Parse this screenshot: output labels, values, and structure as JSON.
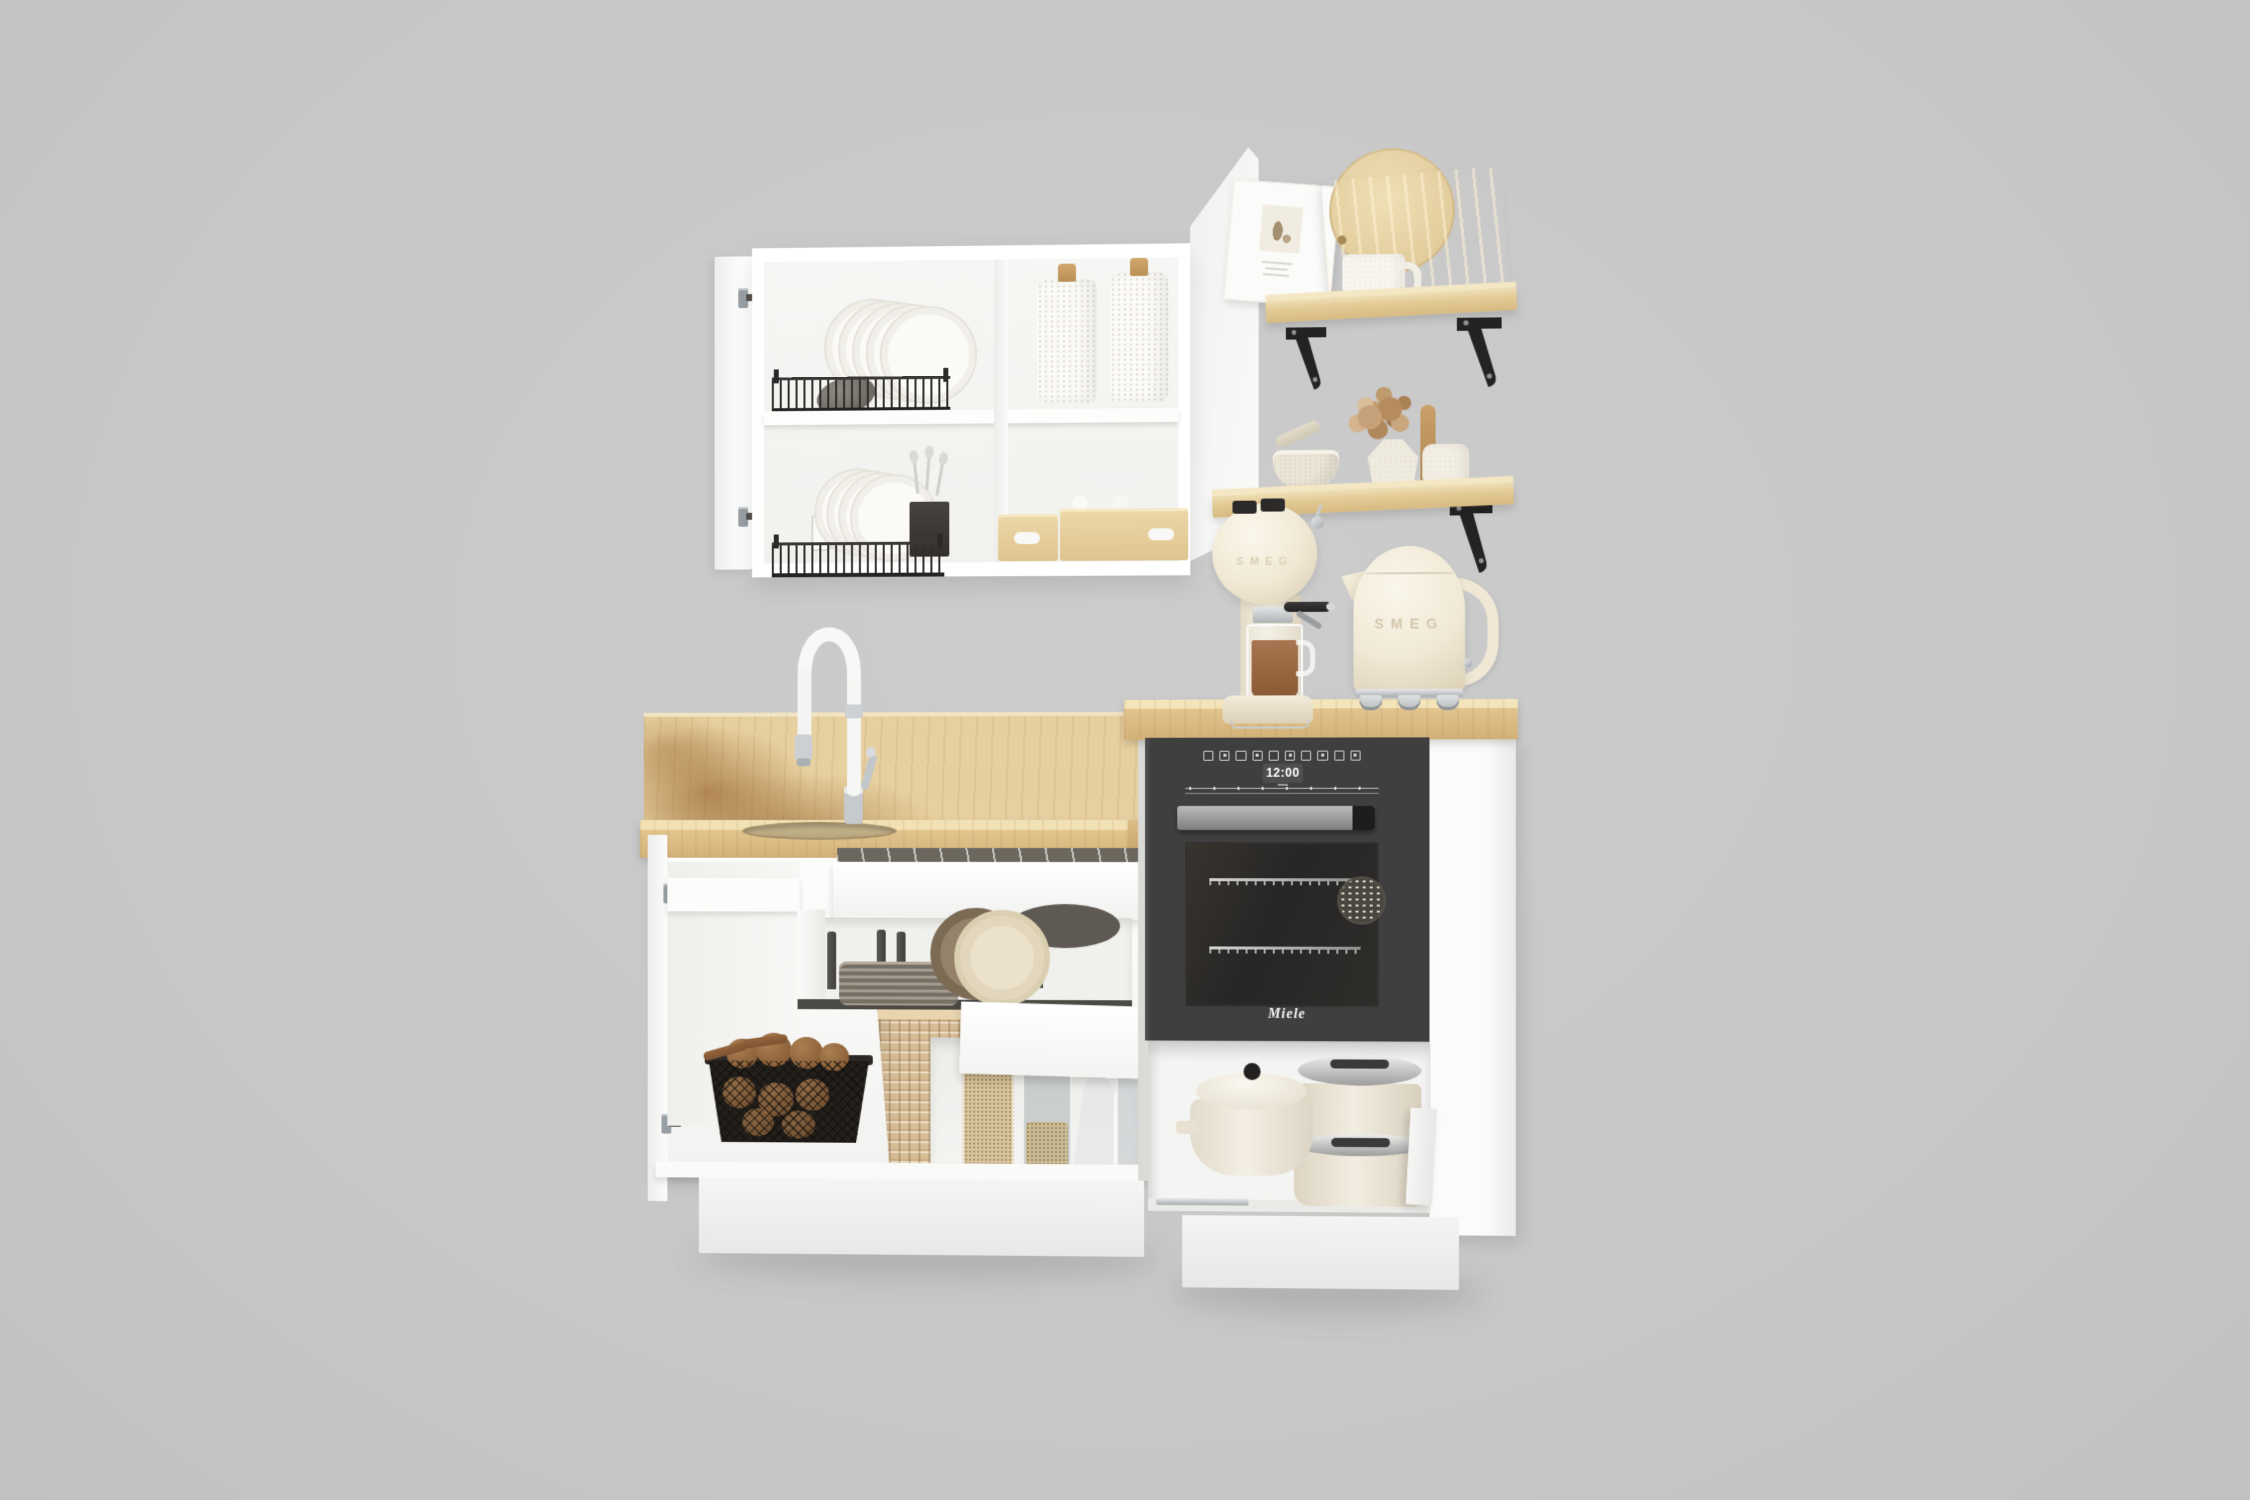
{
  "scene": {
    "name": "kitchen-set-3d-render",
    "background": "#c9c9c9"
  },
  "palette": {
    "cabinet_white": "#fcfcfc",
    "cabinet_shadow": "#ececec",
    "wood_shelf": "#e3cb97",
    "wood_counter": "#dfc28d",
    "wood_grain_dark": "#a4713a",
    "oven_body": "#3f3f3f",
    "oven_window": "#2a2a2a",
    "oven_handle_grey": "#9b9b9b",
    "appliance_cream": "#f2ebd9",
    "chrome": "#d6d9db",
    "bracket_black": "#232323",
    "rattan_tan": "#d9c09a",
    "plate_grey": "#8d847a",
    "plate_cream": "#ece1cb",
    "plate_brown": "#7c6b54",
    "coffee_brown": "#9e6c42",
    "potato_brown": "#9b6f44",
    "grain_oat": "#d9c59c"
  },
  "oven": {
    "brand": "Miele",
    "display_time": "12:00",
    "program_icon_count": 10,
    "touch_icon_count": 8
  },
  "kettle": {
    "brand": "SMEG"
  },
  "coffee_machine": {
    "brand": "SMEG"
  }
}
